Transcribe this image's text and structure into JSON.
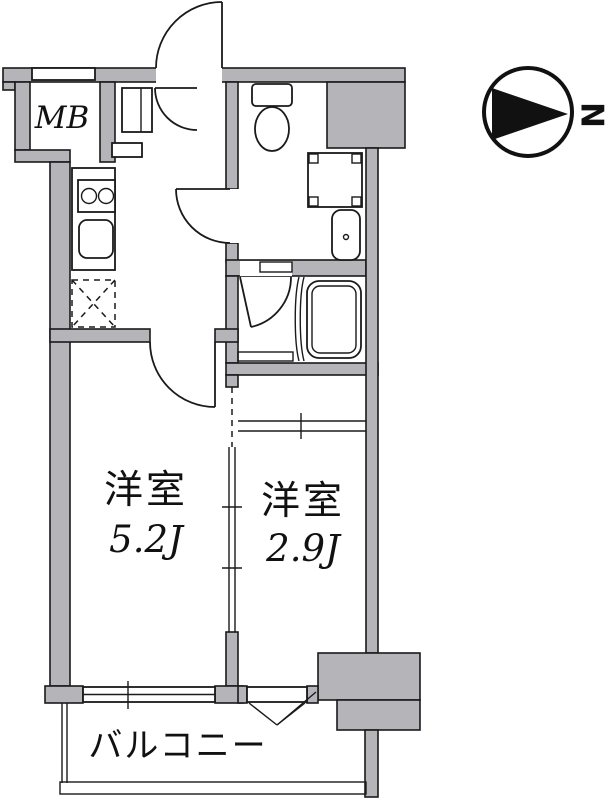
{
  "page": {
    "background": "#ffffff",
    "wall_fill": "#b5b5b9",
    "line_color": "#1a1a1a",
    "width_px": 606,
    "height_px": 800
  },
  "labels": {
    "meter_box": "MB",
    "compass_north": "N",
    "room_main": {
      "name": "洋室",
      "size": "5.2J"
    },
    "room_second": {
      "name": "洋室",
      "size": "2.9J"
    },
    "balcony": "バルコニー"
  },
  "fixtures": [
    "entrance-door",
    "hall-door",
    "shoe-cabinet",
    "kitchen-stove",
    "kitchen-sink",
    "refrigerator-space",
    "washroom-door",
    "toilet",
    "washing-machine-pan",
    "washbasin",
    "bathtub",
    "bathroom-door",
    "room-door",
    "sliding-partition",
    "sliding-window",
    "balcony-railing",
    "compass-north-arrow"
  ]
}
